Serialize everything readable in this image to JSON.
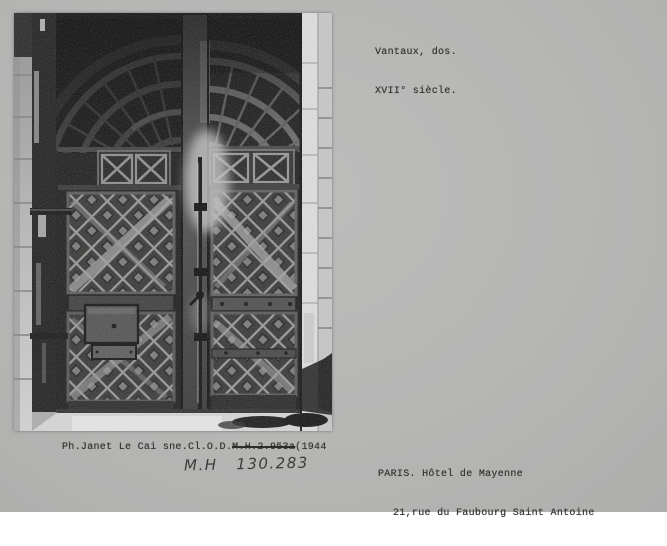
{
  "captions": {
    "classification": {
      "line1": "Vantaux, dos.",
      "line2": "XVII° siècle."
    },
    "credit": {
      "prefix": "Ph.Janet Le Cai sne.Cl.O.D.",
      "struck": "M.H.2.953a",
      "suffix": "(1944"
    },
    "handwritten_ref": "M.H   130.283",
    "location": {
      "line1": "PARIS. Hôtel de Mayenne",
      "line2": "21,rue du Faubourg Saint Antoine"
    }
  },
  "colors": {
    "card_background": "#b5b5b4",
    "typewriter_ink": "#35322e",
    "handwriting_ink": "#3d3a37",
    "photo_shadow_dark": "#141414",
    "photo_wood_mid": "#5a5a5a",
    "photo_jamb_light": "#d8d8d8",
    "photo_floor_light": "#dedede"
  }
}
